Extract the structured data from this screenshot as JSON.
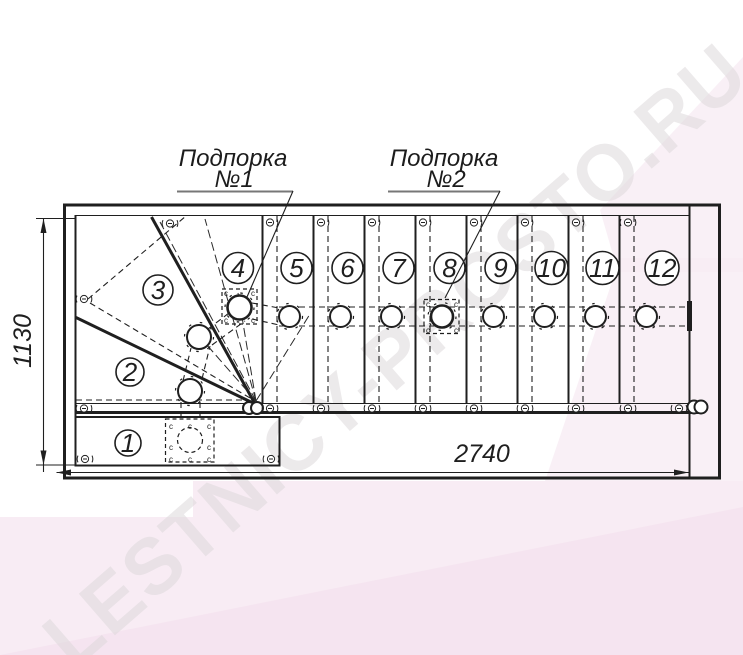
{
  "title": "Staircase plan drawing",
  "watermark": {
    "text": "LESTNICY-PROSTO.RU"
  },
  "supports": {
    "s1_line1": "Подпорка",
    "s1_line2": "№1",
    "s2_line1": "Подпорка",
    "s2_line2": "№2"
  },
  "dimensions": {
    "stair_length": "2740",
    "stair_width": "1130"
  },
  "step_numbers": [
    "1",
    "2",
    "3",
    "4",
    "5",
    "6",
    "7",
    "8",
    "9",
    "10",
    "11",
    "12"
  ],
  "marks": {
    "weld": "c"
  },
  "colors": {
    "line": "#1f1f1f",
    "watermark_text": "#ded9dc",
    "watermark_pink": "#f8ecf4",
    "paper": "#ffffff"
  }
}
